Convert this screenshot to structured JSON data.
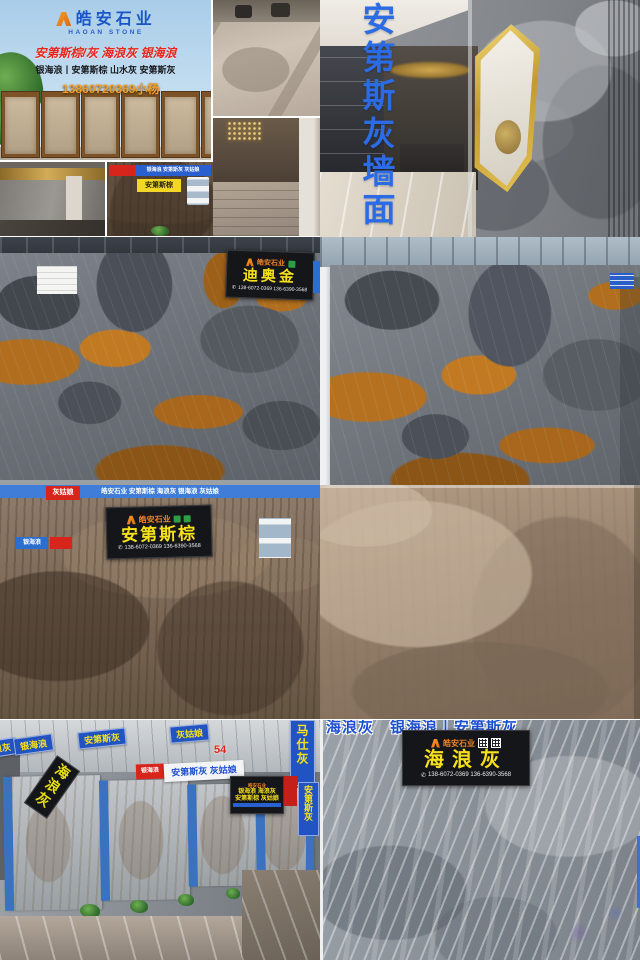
{
  "brand": {
    "name_cn": "皓安石业",
    "name_en": "HAOAN STONE"
  },
  "icons": {
    "phone": "✆"
  },
  "tiles": {
    "storefront": {
      "red_line": "安第斯棕/灰  海浪灰  银海浪",
      "black_line": "银海浪丨安第斯棕  山水灰  安第斯灰",
      "phone": "13860720369小杨"
    },
    "grey_wall": {
      "vertical_text": "安第斯灰墙面"
    },
    "brown_thumb": {
      "banner": "银海浪 安第斯灰 灰姑娘",
      "tag": "安第斯棕"
    },
    "dior_left": {
      "brand": "皓安石业",
      "name": "迪奥金",
      "phone": "138-6072-0369 136-6390-3568"
    },
    "andes_brown": {
      "top_banner": "皓安石业  安第斯棕  海浪灰  银海浪  灰姑娘",
      "red_tag": "灰姑娘",
      "blue_tag": "银海浪",
      "brand": "皓安石业",
      "name": "安第斯棕",
      "phone": "138-6072-0369 136-6390-3568"
    },
    "showroom": {
      "banner0": "海浪灰",
      "banner1": "银海浪",
      "banner2": "安第斯灰",
      "banner3": "灰姑娘",
      "vertical_banner": "马仕灰",
      "stall_no": "54",
      "diag_sign": "海浪灰",
      "red_tag": "银海浪",
      "white_sign": "安第斯灰 灰姑娘",
      "black_sign_brand": "皓安石业",
      "black_sign_line1": "银海浪 海浪灰",
      "black_sign_line2": "安第斯棕 灰姑娘",
      "side_tag": "安第斯灰"
    },
    "sea_wave": {
      "top_text": "海浪灰　银海浪丨安第斯灰",
      "brand": "皓安石业",
      "name": "海浪灰",
      "phone": "138-6072-0369 136-6390-3568"
    }
  }
}
